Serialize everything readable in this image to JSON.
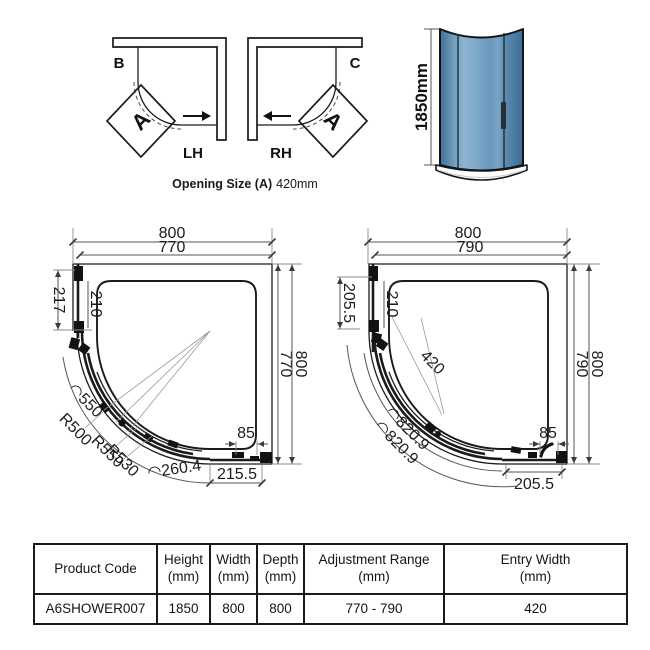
{
  "orientation": {
    "label_b": "B",
    "label_c": "C",
    "label_lh": "LH",
    "label_rh": "RH",
    "door_left": "A",
    "door_right": "A",
    "caption_label": "Opening Size (A)",
    "caption_value": "420mm"
  },
  "render": {
    "height_label": "1850mm",
    "glass_color": "#6F9ABD"
  },
  "plan_left": {
    "top_outer": "800",
    "top_inner": "770",
    "left_outer": "217",
    "left_inner": "210",
    "right_inner": "770",
    "right_outer": "800",
    "arc_length_top": "◠550",
    "radius_1": "R500",
    "radius_2": "R550",
    "radius_3": "R530",
    "arc_length_bottom": "◠260.4",
    "bottom_segment": "215.5",
    "handle_offset": "85"
  },
  "plan_right": {
    "top_outer": "800",
    "top_inner": "790",
    "left_outer": "205.5",
    "left_inner": "210",
    "entry_width": "420",
    "right_inner": "790",
    "right_outer": "800",
    "arc_length_outer": "◠820.9",
    "arc_length_inner": "◠820.9",
    "bottom_segment": "205.5",
    "handle_offset": "85"
  },
  "spec_table": {
    "headers": [
      {
        "top": "Product Code",
        "bottom": ""
      },
      {
        "top": "Height",
        "bottom": "(mm)"
      },
      {
        "top": "Width",
        "bottom": "(mm)"
      },
      {
        "top": "Depth",
        "bottom": "(mm)"
      },
      {
        "top": "Adjustment Range",
        "bottom": "(mm)"
      },
      {
        "top": "Entry Width",
        "bottom": "(mm)"
      }
    ],
    "row": [
      "A6SHOWER007",
      "1850",
      "800",
      "800",
      "770 - 790",
      "420"
    ]
  }
}
